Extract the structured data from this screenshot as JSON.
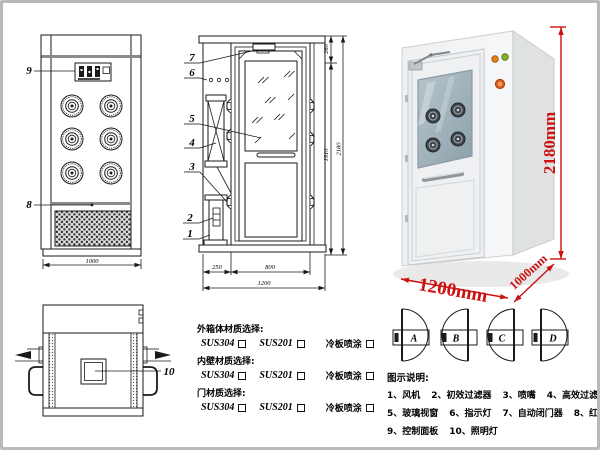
{
  "page": {
    "border_color": "#b9b9b9",
    "background": "#ffffff"
  },
  "front_view": {
    "label_9": "9",
    "label_8": "8",
    "dim_width": "1000"
  },
  "side_view": {
    "labels": {
      "n1": "1",
      "n2": "2",
      "n3": "3",
      "n4": "4",
      "n5": "5",
      "n6": "6",
      "n7": "7"
    },
    "dim_left": "250",
    "dim_door": "800",
    "dim_total_width": "1200",
    "dim_top": "260",
    "dim_mid": "1910",
    "dim_total_height": "2180"
  },
  "top_view": {
    "label_10": "10"
  },
  "photo": {
    "dim_height": "2180mm",
    "dim_width": "1200mm",
    "dim_depth": "1000mm",
    "accent_color": "#cc1111"
  },
  "materials": {
    "sections": [
      {
        "title": "外箱体材质选择:",
        "opt1": "SUS304",
        "opt2": "SUS201",
        "opt3": "冷板喷涂"
      },
      {
        "title": "内壁材质选择:",
        "opt1": "SUS304",
        "opt2": "SUS201",
        "opt3": "冷板喷涂"
      },
      {
        "title": "门材质选择:",
        "opt1": "SUS304",
        "opt2": "SUS201",
        "opt3": "冷板喷涂"
      }
    ]
  },
  "door_options": {
    "a": "A",
    "b": "B",
    "c": "C",
    "d": "D"
  },
  "legend": {
    "title": "图示说明:",
    "items": [
      "1、风机",
      "2、初效过滤器",
      "3、喷嘴",
      "4、高效过滤器",
      "5、玻璃视窗",
      "6、指示灯",
      "7、自动闭门器",
      "8、红外线感应器",
      "9、控制面板",
      "10、照明灯"
    ]
  }
}
